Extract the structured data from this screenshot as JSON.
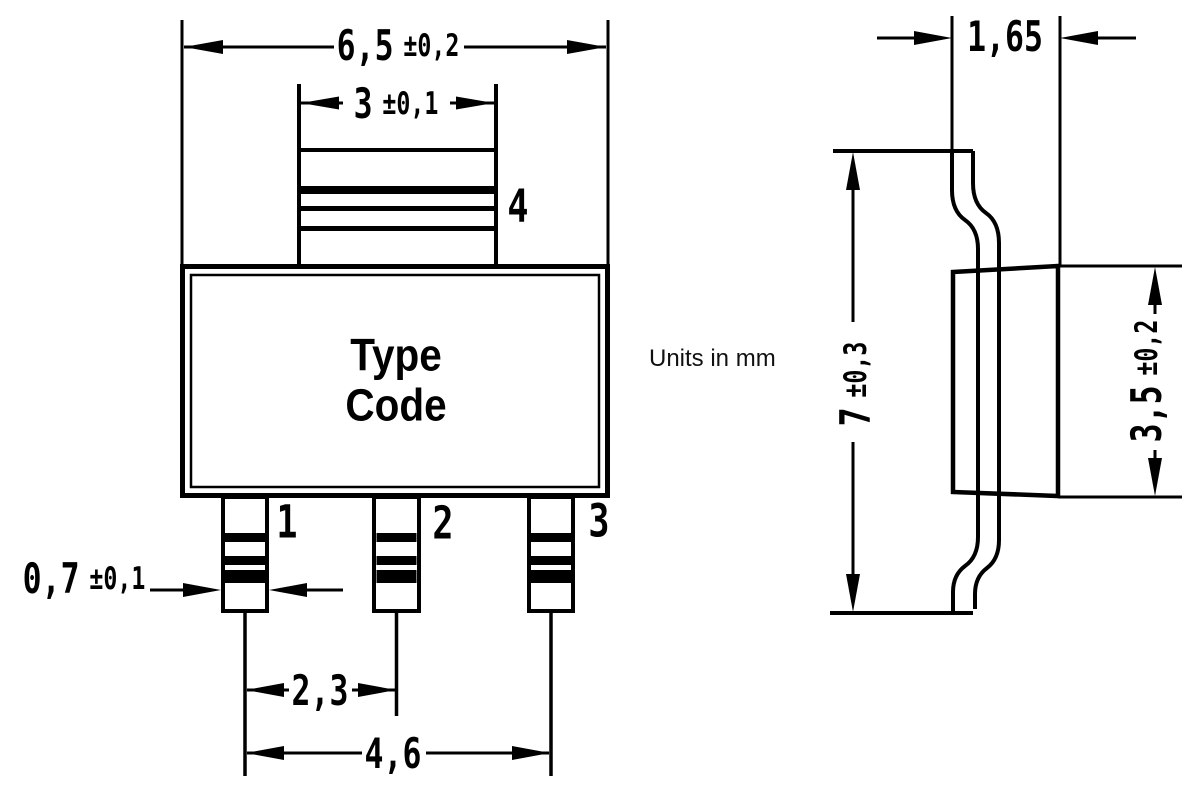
{
  "note": {
    "units": "Units in mm"
  },
  "front_view": {
    "type_code": "Type\nCode",
    "pin_labels": {
      "pin1": "1",
      "pin2": "2",
      "pin3": "3",
      "pin4": "4"
    },
    "dimensions": {
      "body_width": {
        "value": "6,5",
        "tolerance": "±0,2"
      },
      "tab_width": {
        "value": "3",
        "tolerance": "±0,1"
      },
      "pin_width": {
        "value": "0,7",
        "tolerance": "±0,1"
      },
      "pin_pitch": {
        "value": "2,3"
      },
      "pin_span": {
        "value": "4,6"
      }
    }
  },
  "side_view": {
    "dimensions": {
      "lead_thickness": {
        "value": "1,65"
      },
      "overall_height": {
        "value": "7",
        "tolerance": "±0,3"
      },
      "body_height": {
        "value": "3,5",
        "tolerance": "±0,2"
      }
    }
  },
  "colors": {
    "line": "#000000",
    "background": "#ffffff"
  }
}
